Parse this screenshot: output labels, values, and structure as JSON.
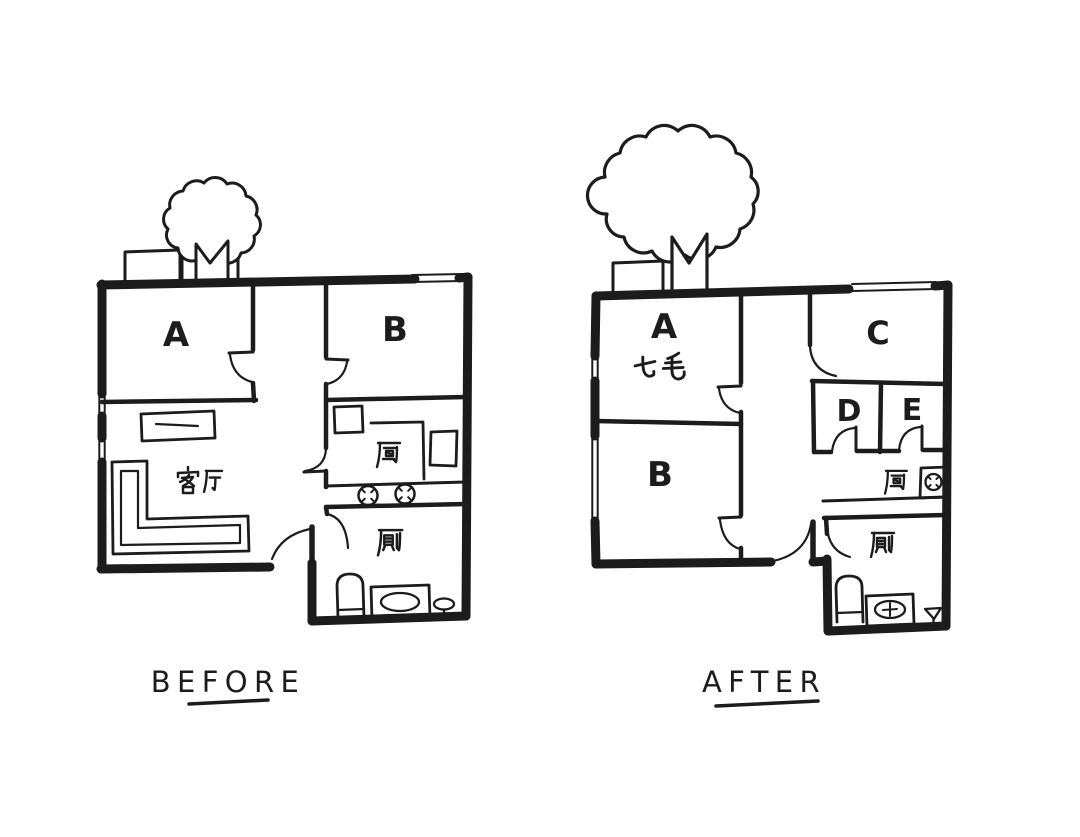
{
  "page": {
    "background": "#ffffff",
    "ink_color": "#1c1c1c"
  },
  "panels": {
    "before": {
      "caption": "BEFORE",
      "room_labels": {
        "a": "A",
        "b": "B"
      },
      "area_labels": {
        "living_room": "客厅",
        "kitchen": "厨",
        "bathroom": "厕"
      },
      "icons": [
        "tree-icon",
        "bay-window-icon",
        "tv-cabinet-icon",
        "sofa-icon",
        "kitchen-sink-icon",
        "fridge-icon",
        "stove-burners-icon",
        "toilet-icon",
        "bathtub-icon",
        "pedestal-sink-icon",
        "door-swing-icon"
      ]
    },
    "after": {
      "caption": "AFTER",
      "room_labels": {
        "a": "A",
        "b": "B",
        "c": "C",
        "d": "D",
        "e": "E"
      },
      "annotation": "七毛",
      "area_labels": {
        "kitchen": "厨",
        "bathroom": "厕"
      },
      "icons": [
        "tree-icon",
        "bay-window-icon",
        "stove-burner-icon",
        "vanity-sink-icon",
        "toilet-icon",
        "pedestal-sink-icon",
        "door-swing-icon"
      ]
    }
  }
}
